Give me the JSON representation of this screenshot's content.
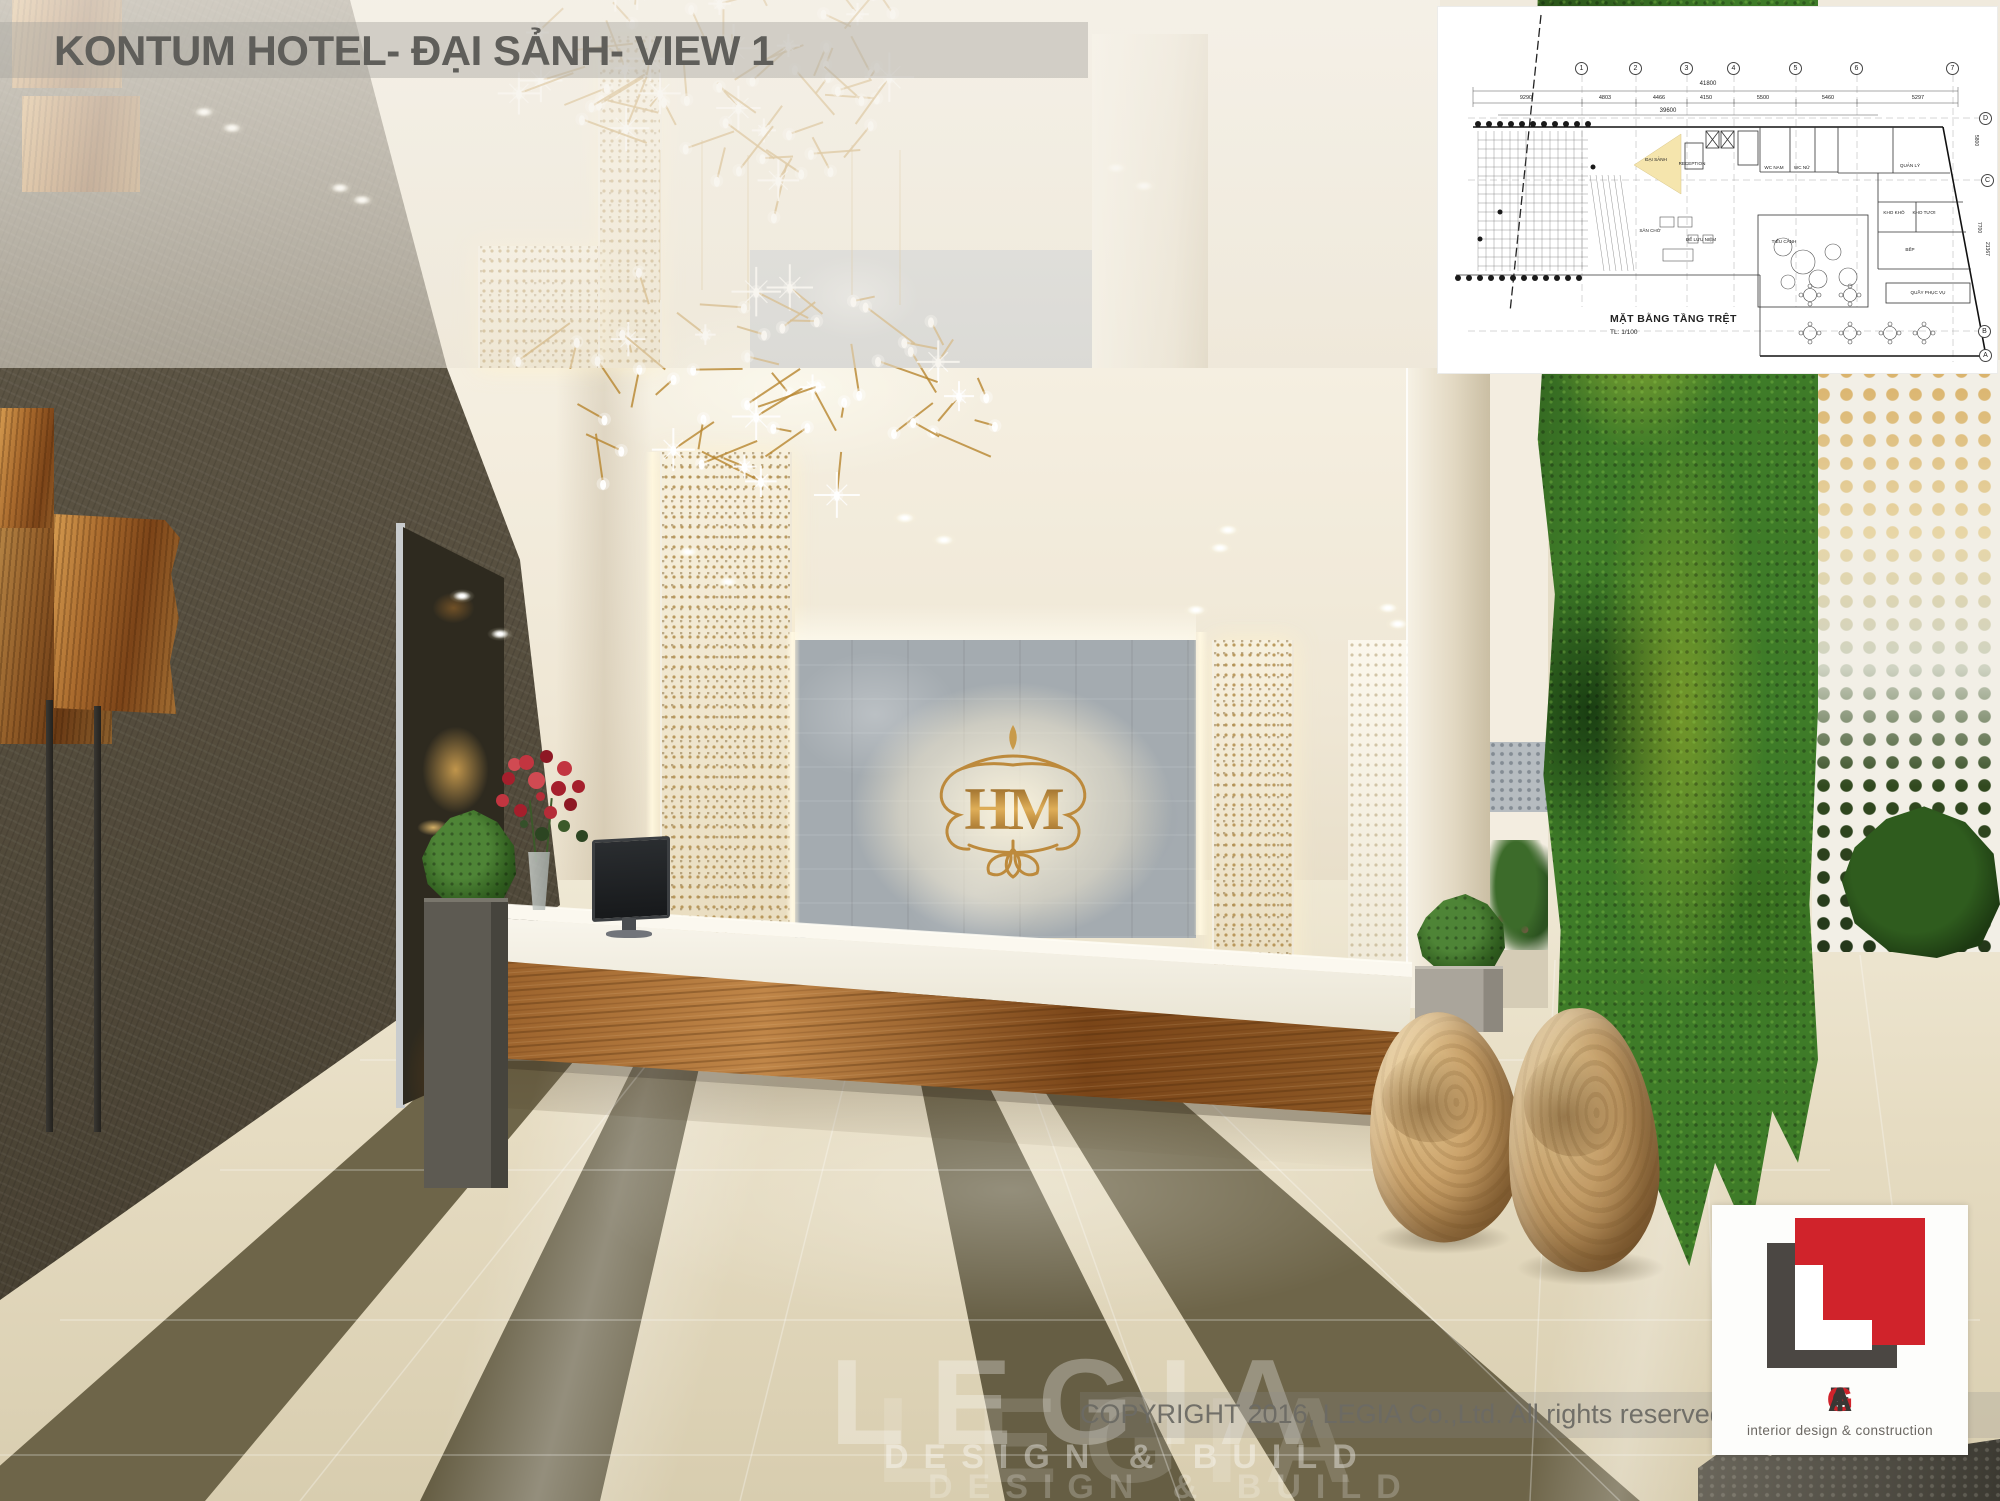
{
  "header": {
    "title": "KONTUM HOTEL- ĐẠI SẢNH- VIEW 1"
  },
  "plan_inset": {
    "caption": "MẶT BẰNG TẦNG TRỆT",
    "scale_label": "TL: 1/100",
    "grid_numbers": [
      "1",
      "2",
      "3",
      "4",
      "5",
      "6",
      "7"
    ],
    "grid_letters": [
      "D",
      "C",
      "B",
      "A"
    ],
    "total_dim_top": "41800",
    "total_dim_bottom": "39600",
    "segment_dims": [
      "9290",
      "4803",
      "4466",
      "4150",
      "5500",
      "5460",
      "5297"
    ],
    "side_dims": [
      "5800",
      "7700",
      "21367"
    ],
    "room_labels": [
      "ĐẠI SẢNH",
      "RECEPTION",
      "WC NAM",
      "WC NỮ",
      "QUẢN LÝ",
      "KHO KHÔ",
      "KHO TƯƠI",
      "BẾP",
      "TIỂU CẢNH",
      "ĐỂ LƯU NIỆM",
      "SÂN CHỜ",
      "QUẦY PHỤC VỤ"
    ]
  },
  "monogram": {
    "text": "HM"
  },
  "watermark": {
    "brand": "LEGIA",
    "tagline": "DESIGN & BUILD"
  },
  "footer": {
    "copyright": "COPYRIGHT 2016, LEGIA Co.,Ltd. All rights reserved"
  },
  "logo_card": {
    "brand_letters": [
      "L",
      "E",
      "G",
      "I",
      "A"
    ],
    "tagline": "interior design & construction"
  },
  "colors": {
    "brand_red": "#d0232b",
    "logo_gray": "#4b4743",
    "gold": "#bd8a3c",
    "title_gray": "#5f5e5a"
  }
}
